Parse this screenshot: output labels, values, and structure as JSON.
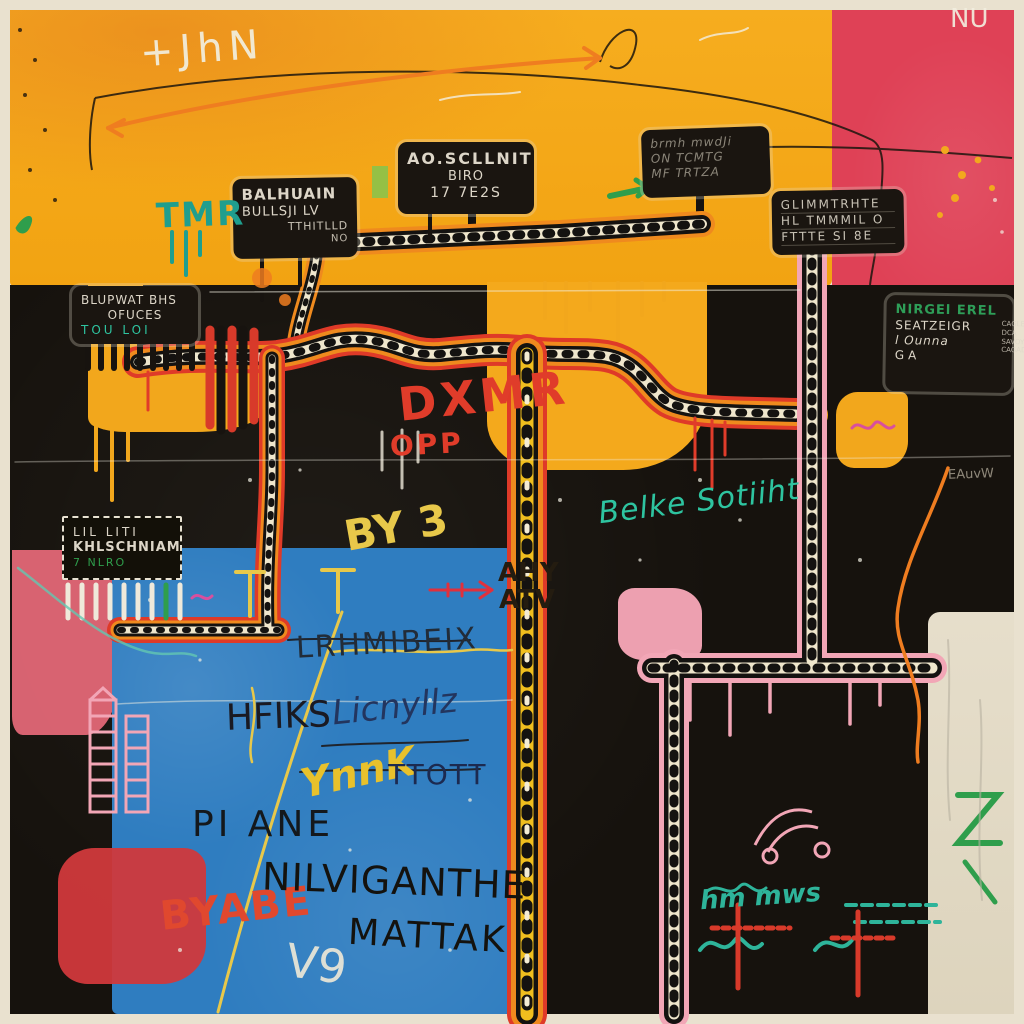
{
  "artwork": {
    "title": "Neo-expressionist street map painting",
    "palette": {
      "yellow": "#f2a71c",
      "red_field": "#df4156",
      "black": "#16120d",
      "blue": "#2f7dc0",
      "road_orange": "#ef8a1e",
      "road_red": "#df3a28",
      "pink": "#f2a6b6",
      "cream": "#e9e1cf",
      "teal": "#2ec4a0",
      "green": "#2f9e4c",
      "graffiti_red": "#e03c2a"
    },
    "signs": [
      {
        "id": "balhuain",
        "lines": [
          "BALHUAIN",
          "BULLSJI LV",
          "TTHITLLD",
          "NO"
        ]
      },
      {
        "id": "aoscllnit",
        "lines": [
          "AO.SCLLNIT",
          "BIRO",
          "17 7E2S"
        ]
      },
      {
        "id": "scrawl",
        "lines": [
          "brmh mwdJi",
          "ON TCMTG",
          "MF TRTZA"
        ]
      },
      {
        "id": "glimmtete",
        "lines": [
          "GLIMMTRHTE",
          "HL TMMMIL O",
          "FTTTE SI 8E"
        ]
      },
      {
        "id": "blupwat",
        "lines": [
          "BLUPWAT BHS",
          "OFUCES",
          "TOU LOI"
        ]
      },
      {
        "id": "nirgel",
        "lines": [
          "NIRGEl EREL",
          "SEATZEIGR",
          "l Ounna",
          "GA"
        ],
        "side_lines": [
          "CAGLEF",
          "DCA",
          "SAVOYS",
          "CAGAD"
        ]
      },
      {
        "id": "khlschniam",
        "lines": [
          "LIL LITI",
          "KHLSCHNIAM",
          "7 NLRO"
        ]
      }
    ],
    "graffiti": {
      "jhn": "+JhN",
      "nu": "NU",
      "tmr": "TMR",
      "dxmr": "DXMR",
      "opp": "OPP",
      "by3": "BY 3",
      "ahy": "AHY",
      "atv": "ATV",
      "lrhm": "LRHMIBEIX",
      "hfiks": "HFIKS",
      "licny": "Licnyllz",
      "ynnk": "YnnK",
      "ttott": "TTOTT",
      "piane": "PI ANE",
      "byabe": "BYABE",
      "nilviganthe": "NILVIGANTHE",
      "mattak": "MATTAK",
      "v9": "V9",
      "belke": "Belke Sotiiht",
      "hmm": "hm mws",
      "eauw": "EAuvW"
    }
  }
}
